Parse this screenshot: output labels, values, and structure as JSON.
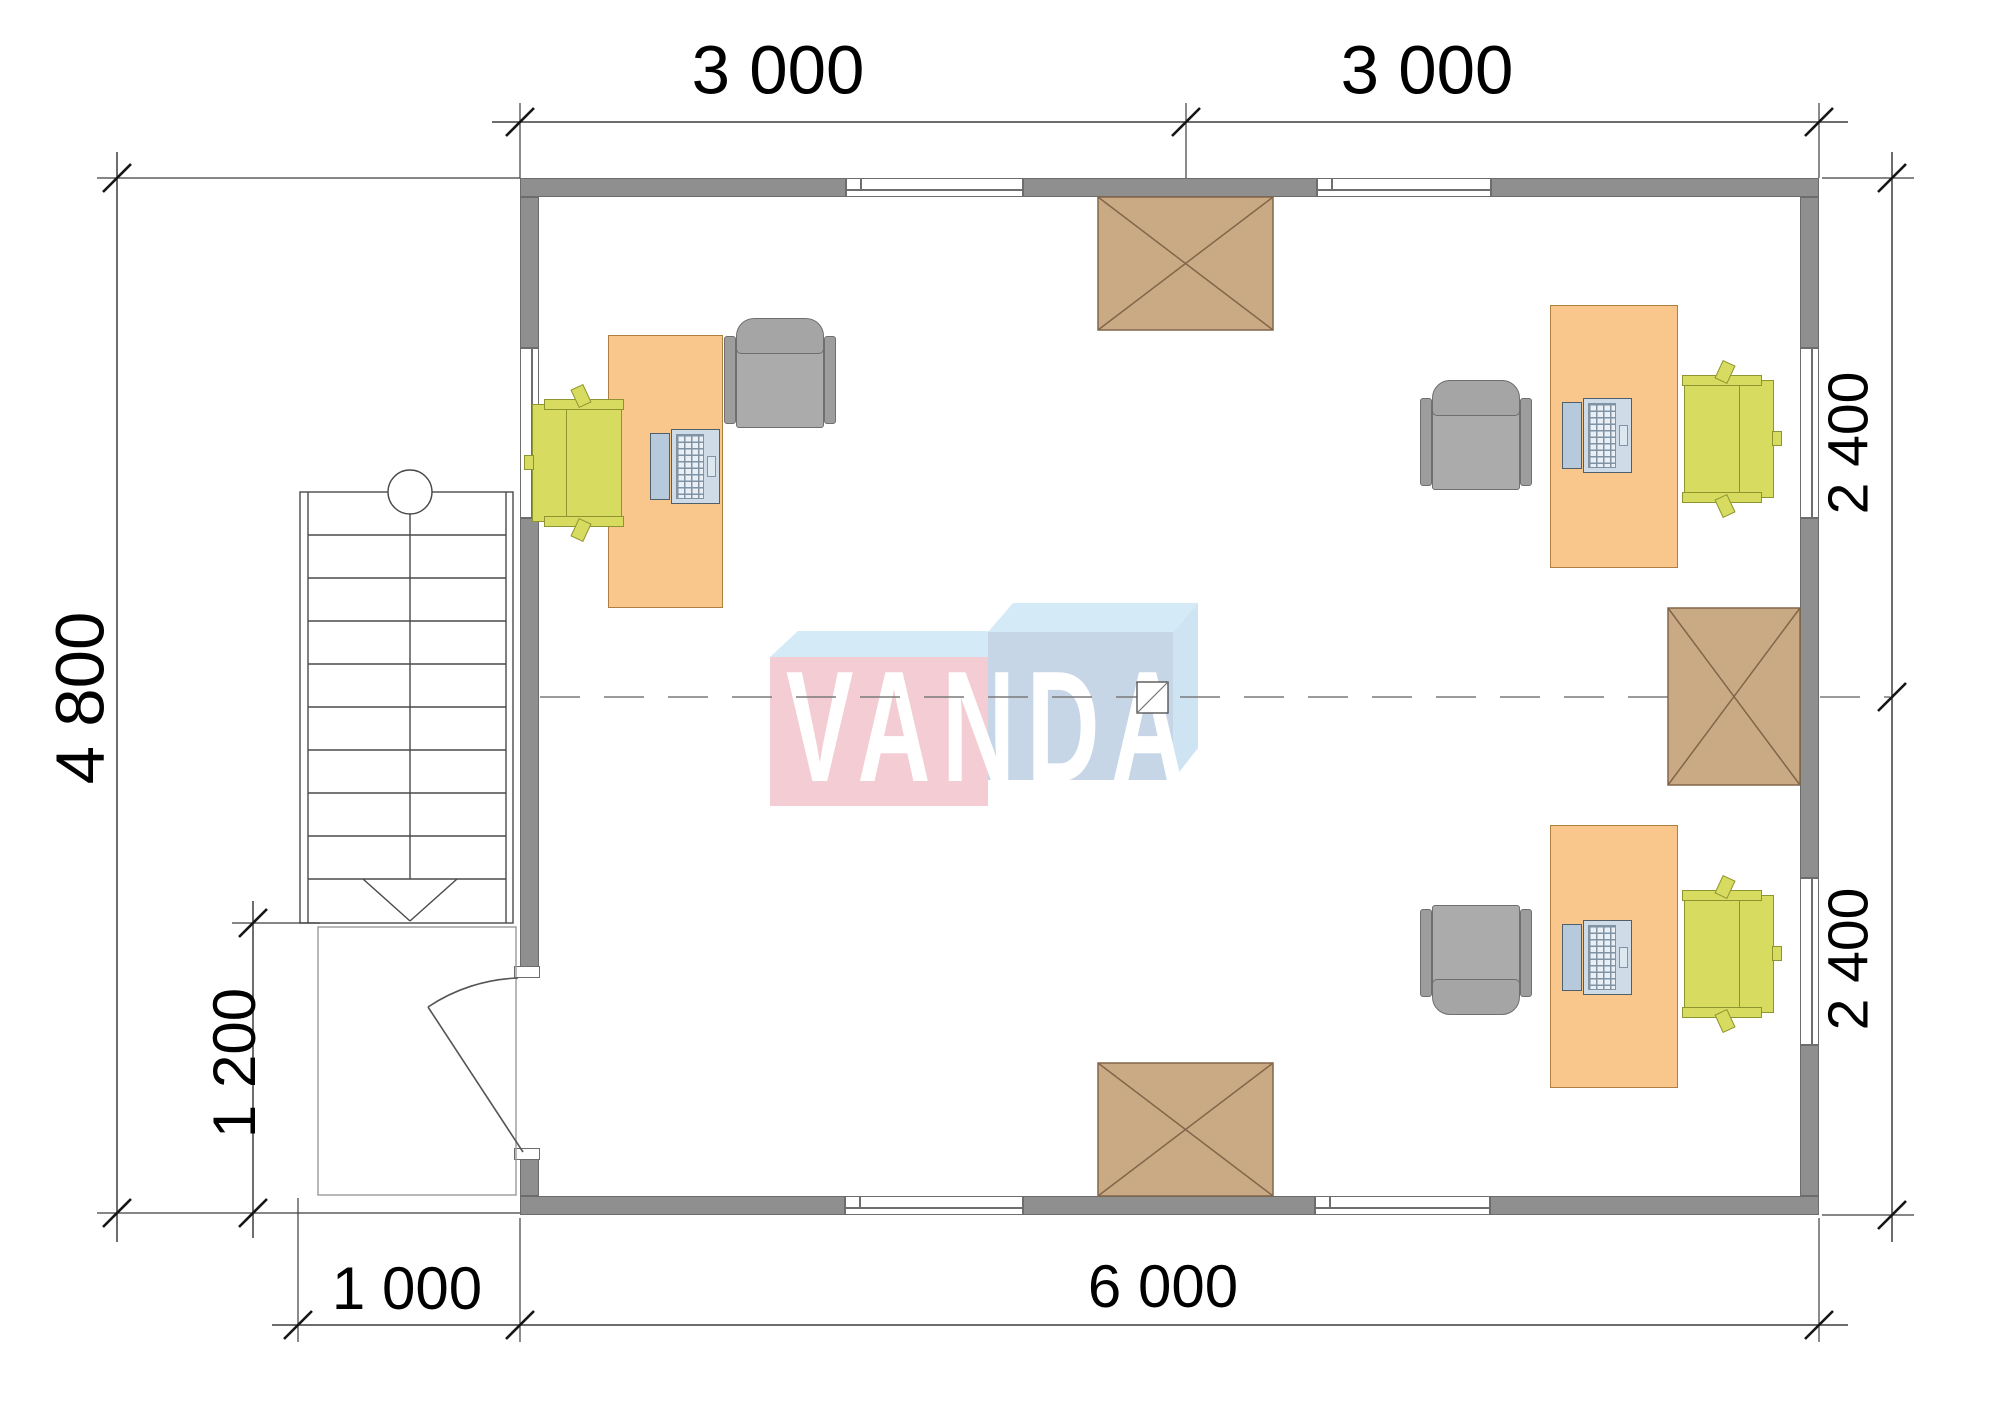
{
  "watermark": {
    "left": "VAN",
    "right": "DA",
    "full": "VANDA"
  },
  "dimensions": {
    "top_left": "3 000",
    "top_right": "3 000",
    "left_overall": "4 800",
    "porch_height": "1 200",
    "porch_width": "1 000",
    "bottom_overall": "6 000",
    "right_upper": "2 400",
    "right_lower": "2 400"
  },
  "plan_contents": {
    "workstations": 3,
    "desks": 3,
    "office_chairs_gray": 3,
    "office_chairs_green": 3,
    "laptops": 3,
    "hatched_columns": 3,
    "windows": 7,
    "exterior_door": 1,
    "staircase": 1,
    "entry_porch": 1
  },
  "colors": {
    "wall": "#8f8f8f",
    "desk": "#f9c78c",
    "chair_green": "#d7db60",
    "chair_gray": "#a5a5a5",
    "column_hatch": "#c9aa84",
    "logo_pink": "#f4cdd4",
    "logo_blue": "#c6d6e6",
    "logo_top_face": "#d4ebf7",
    "dimension_text": "#000000"
  }
}
